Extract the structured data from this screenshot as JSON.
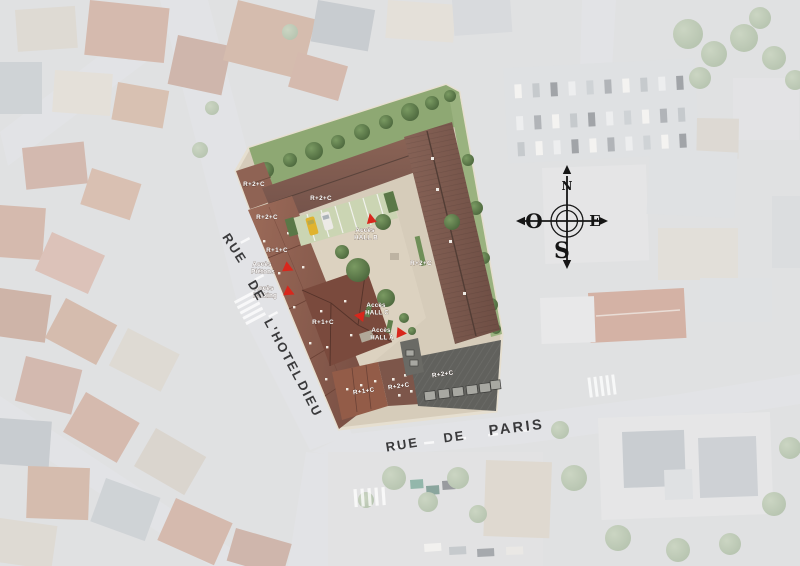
{
  "site": {
    "roof_labels": [
      {
        "id": "nw-wing",
        "text": "R+2+C"
      },
      {
        "id": "north-wing",
        "text": "R+2+C"
      },
      {
        "id": "west-upper",
        "text": "R+2+C"
      },
      {
        "id": "west-wing",
        "text": "R+1+C"
      },
      {
        "id": "east-wing",
        "text": "R+2+C"
      },
      {
        "id": "southwest",
        "text": "R+1+C"
      },
      {
        "id": "south-left",
        "text": "R+1+C"
      },
      {
        "id": "south-right",
        "text": "R+2+C"
      },
      {
        "id": "flat-roof",
        "text": "R+2+C"
      }
    ],
    "access_labels": [
      {
        "id": "hall-b",
        "line1": "Accès",
        "line2": "HALL B",
        "marker": "red-triangle-up"
      },
      {
        "id": "pietons",
        "line1": "Accès",
        "line2": "Piétons",
        "marker": "red-triangle-right"
      },
      {
        "id": "parking",
        "line1": "Accès",
        "line2": "Parking",
        "marker": "red-triangle-right"
      },
      {
        "id": "hall-c",
        "line1": "Accès",
        "line2": "HALL C",
        "marker": "red-triangle-left"
      },
      {
        "id": "hall-a",
        "line1": "Accès",
        "line2": "HALL A",
        "marker": "red-triangle-right"
      }
    ]
  },
  "streets": {
    "hotel_dieu": {
      "words": [
        "RUE",
        "DE",
        "L'HOTEL",
        "DIEU"
      ]
    },
    "paris": {
      "words": [
        "RUE",
        "DE",
        "PARIS"
      ]
    }
  },
  "compass": {
    "north": "N",
    "south": "S",
    "east": "E",
    "west": "O"
  },
  "colors": {
    "accent_red": "#d8271c",
    "roof_brown": "#7f5c50",
    "roof_red_brown": "#8c5c4c",
    "flat_roof_gray": "#61615d",
    "landscape_green": "#587546",
    "courtyard_beige": "#d6ccba"
  }
}
